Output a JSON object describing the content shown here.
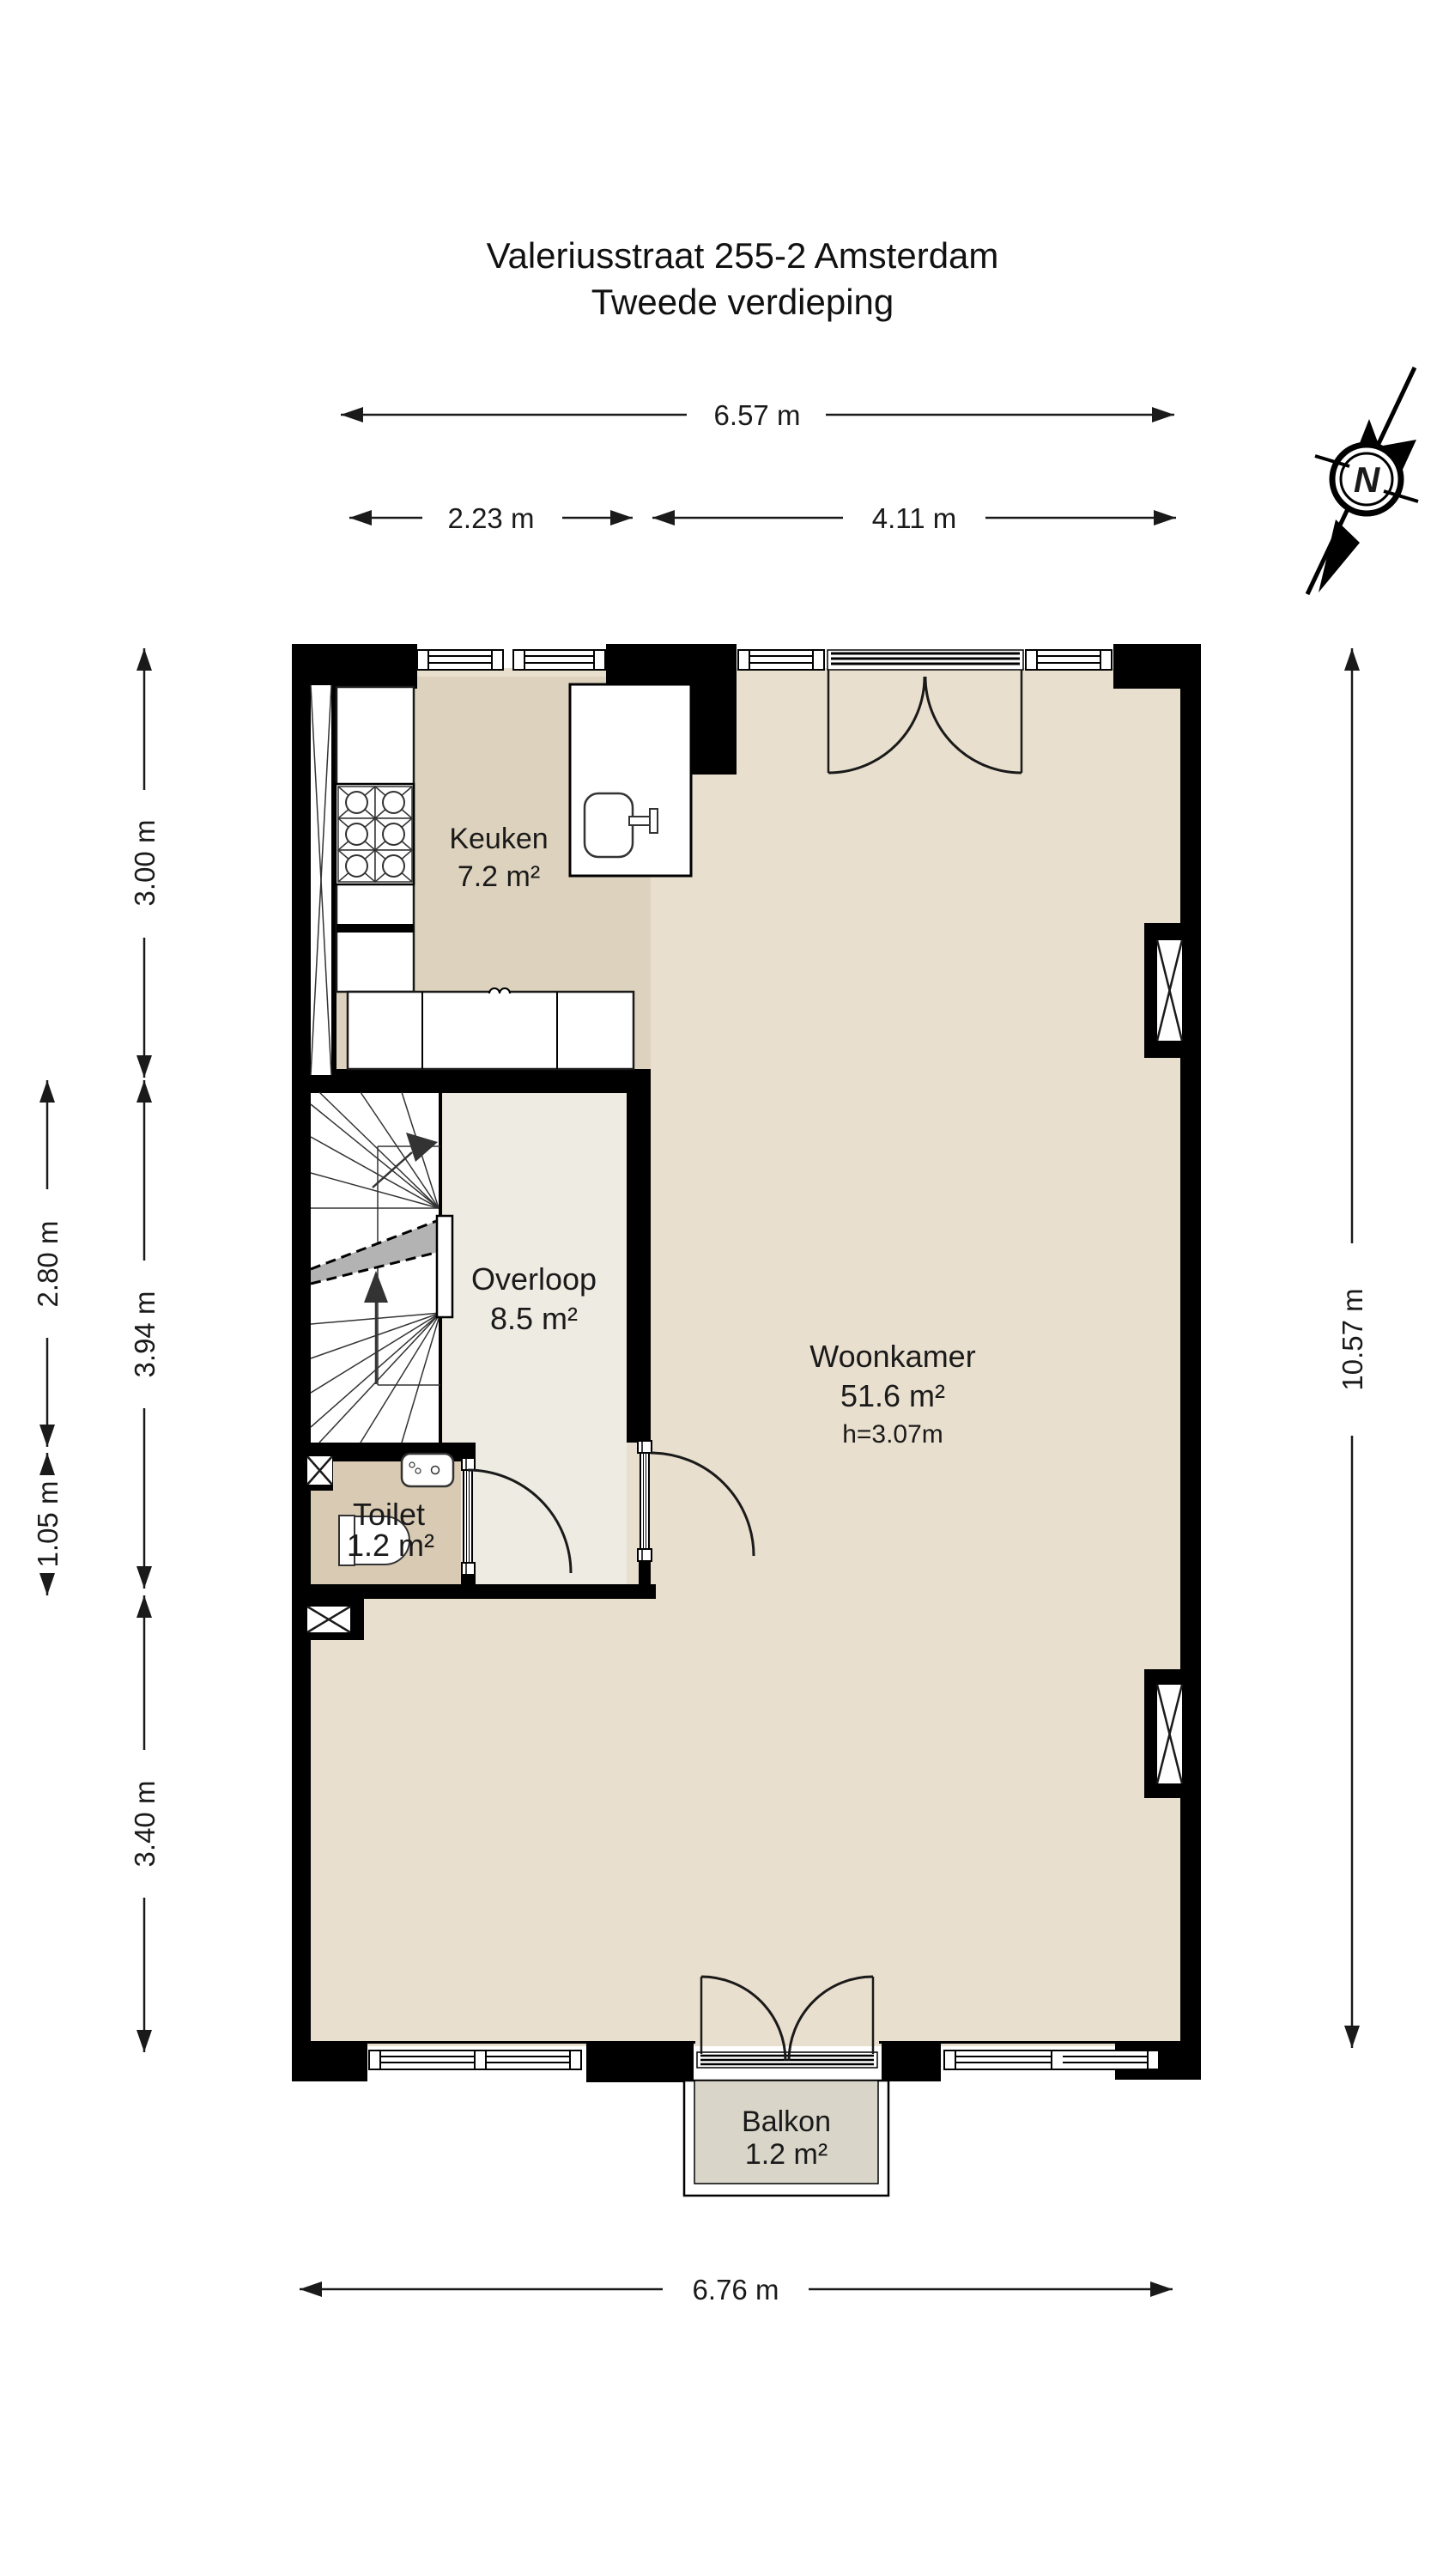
{
  "title": {
    "line1": "Valeriusstraat 255-2 Amsterdam",
    "line2": "Tweede verdieping"
  },
  "compass": {
    "north_label": "N",
    "icon": "north-arrow"
  },
  "rooms": {
    "keuken": {
      "name": "Keuken",
      "area": "7.2 m²"
    },
    "overloop": {
      "name": "Overloop",
      "area": "8.5 m²"
    },
    "woonkamer": {
      "name": "Woonkamer",
      "area": "51.6 m²",
      "height": "h=3.07m"
    },
    "toilet": {
      "name": "Toilet",
      "area": "1.2 m²"
    },
    "balkon": {
      "name": "Balkon",
      "area": "1.2 m²"
    }
  },
  "dimensions": {
    "top_total": "6.57 m",
    "top_left": "2.23 m",
    "top_right": "4.11 m",
    "left_upper": "3.00 m",
    "left_middle": "3.94 m",
    "left_lower": "3.40 m",
    "left_outer_upper": "2.80 m",
    "left_outer_lower": "1.05 m",
    "right_total": "10.57 m",
    "bottom_total": "6.76 m"
  },
  "colors": {
    "wall": "#000000",
    "floor_woonkamer": "#e9dfce",
    "floor_keuken": "#ddd2bd",
    "floor_overloop": "#edebe2",
    "floor_toilet": "#d9cbb3",
    "floor_balkon": "#d9d5c9",
    "handrail": "#b3b3b3"
  }
}
